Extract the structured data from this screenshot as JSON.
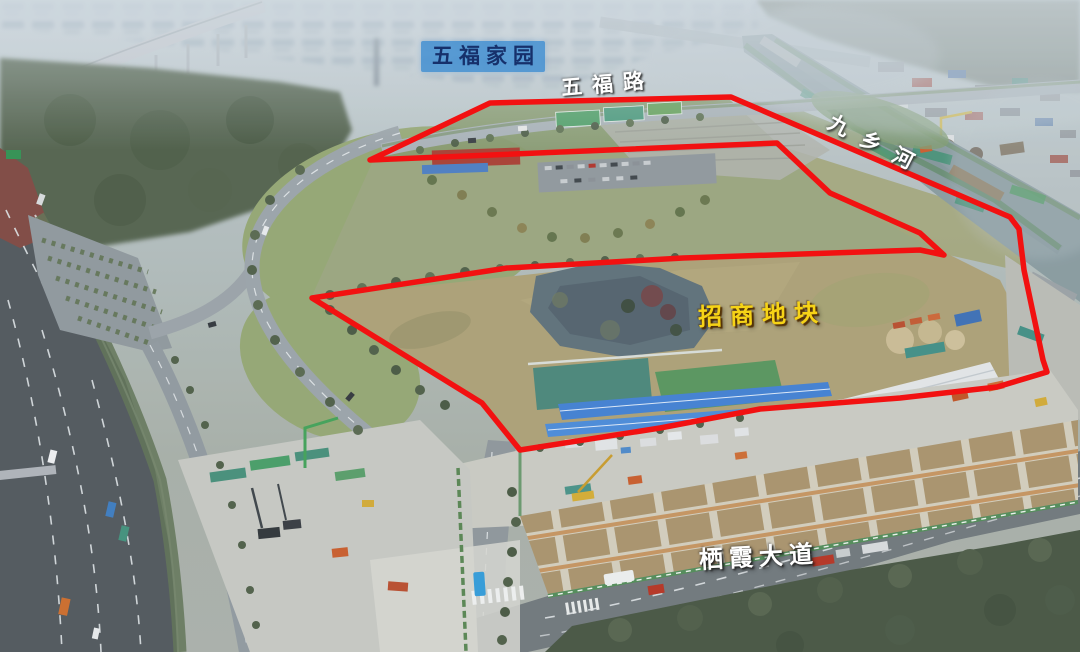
{
  "scene": {
    "description": "Hazy aerial drone photograph of riverside land parcels outlined in red, with a highway on the left, Jiuxiang River on the right and the Qixia Avenue construction site in the foreground",
    "haze_color": "#c3ced4",
    "field_color": "#ab9f74",
    "river_color": "#87999e",
    "road_color": "#8d9499"
  },
  "labels": {
    "estate": {
      "text": "五福家园",
      "text_color": "#16306b",
      "box_color": "rgba(62,142,210,0.82)"
    },
    "road_top": {
      "text": "五福路",
      "color": "#ffffff"
    },
    "river": {
      "text": "九乡河",
      "color": "#ffffff"
    },
    "plot": {
      "text": "招商地块",
      "color": "#f6d316"
    },
    "avenue": {
      "text": "栖霞大道",
      "color": "#ffffff"
    }
  },
  "red_overlay": {
    "color": "#f21111",
    "stroke_width": 5.5,
    "outline_points": "370,160 490,103 731,97 1010,217 1019,229 1024,270 1032,308 1043,360 1047,372 997,387 900,398 760,409 660,428 520,450 482,403 312,298 507,268 683,258 920,250 944,255 920,233 830,193 777,143"
  }
}
